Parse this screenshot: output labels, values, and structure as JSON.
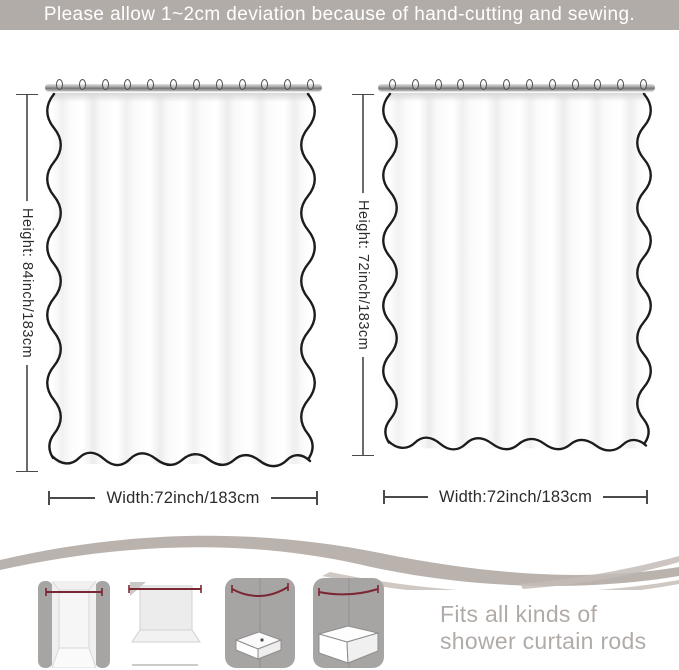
{
  "banner": {
    "text": "Please allow 1~2cm deviation because of hand-cutting and sewing."
  },
  "curtains": {
    "hook_count": 12,
    "left": {
      "height_label": "Height: 84inch/183cm",
      "width_label": "Width:72inch/183cm"
    },
    "right": {
      "height_label": "Height: 72inch/183cm",
      "width_label": "Width:72inch/183cm"
    }
  },
  "footer": {
    "caption_line1": "Fits all kinds of",
    "caption_line2": "shower curtain rods",
    "icons": [
      {
        "label": "straight rod in alcove"
      },
      {
        "label": "straight rod with curtain panel"
      },
      {
        "label": "curved rod over corner shower"
      },
      {
        "label": "curved rod over bathtub"
      }
    ]
  },
  "colors": {
    "banner_bg": "#b2aca9",
    "banner_text": "#ffffff",
    "dimension_line": "#4a4a4a",
    "dimension_text": "#2b2b2b",
    "curtain_outline": "#1c1c1c",
    "icon_wall_gray": "#a7a4a4",
    "icon_rod_red": "#7b2633",
    "swoosh": "#bab2ad",
    "caption_text": "#b1aba8"
  }
}
